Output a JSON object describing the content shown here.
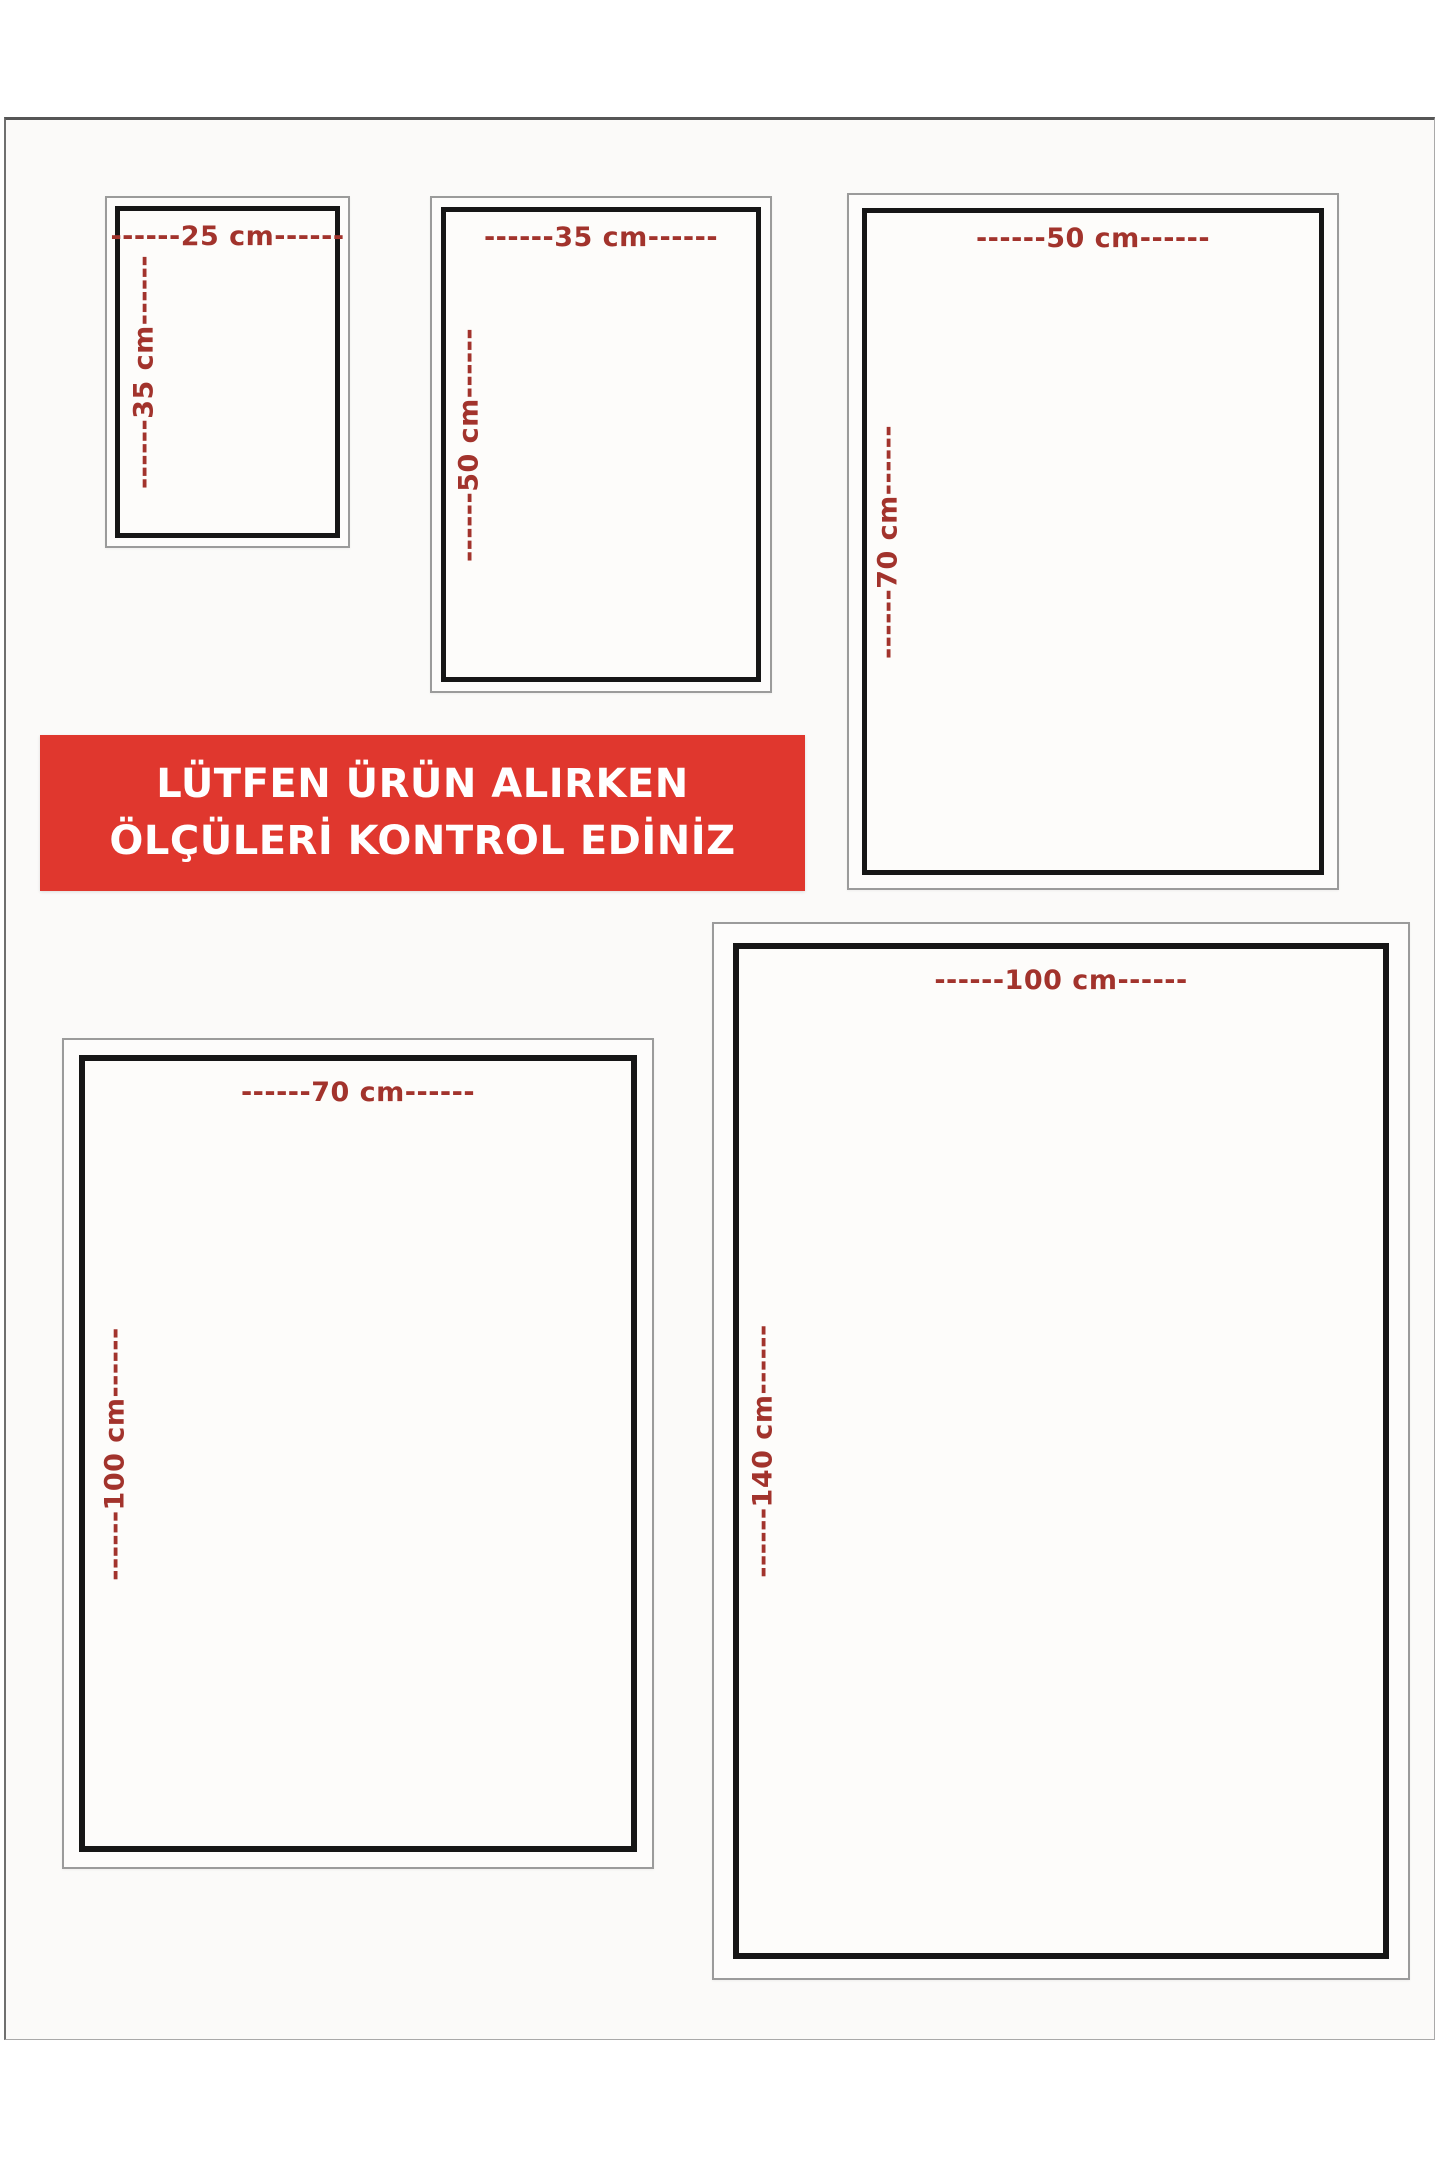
{
  "banner": {
    "line1": "LÜTFEN ÜRÜN ALIRKEN",
    "line2": "ÖLÇÜLERİ KONTROL EDİNİZ",
    "background_color": "#e0372e",
    "text_color": "#ffffff"
  },
  "colors": {
    "dimension_text": "#a2332c",
    "inner_frame": "#161616",
    "outer_frame": "#9b9b9b",
    "page_background": "#fbfaf9"
  },
  "boxes": [
    {
      "name": "25x35",
      "width_cm": 25,
      "height_cm": 35,
      "width_label": "------25 cm------",
      "height_label": "------35 cm------"
    },
    {
      "name": "35x50",
      "width_cm": 35,
      "height_cm": 50,
      "width_label": "------35 cm------",
      "height_label": "------50 cm------"
    },
    {
      "name": "50x70",
      "width_cm": 50,
      "height_cm": 70,
      "width_label": "------50 cm------",
      "height_label": "------70 cm------"
    },
    {
      "name": "70x100",
      "width_cm": 70,
      "height_cm": 100,
      "width_label": "------70 cm------",
      "height_label": "------100 cm------"
    },
    {
      "name": "100x140",
      "width_cm": 100,
      "height_cm": 140,
      "width_label": "------100 cm------",
      "height_label": "------140 cm------"
    }
  ]
}
